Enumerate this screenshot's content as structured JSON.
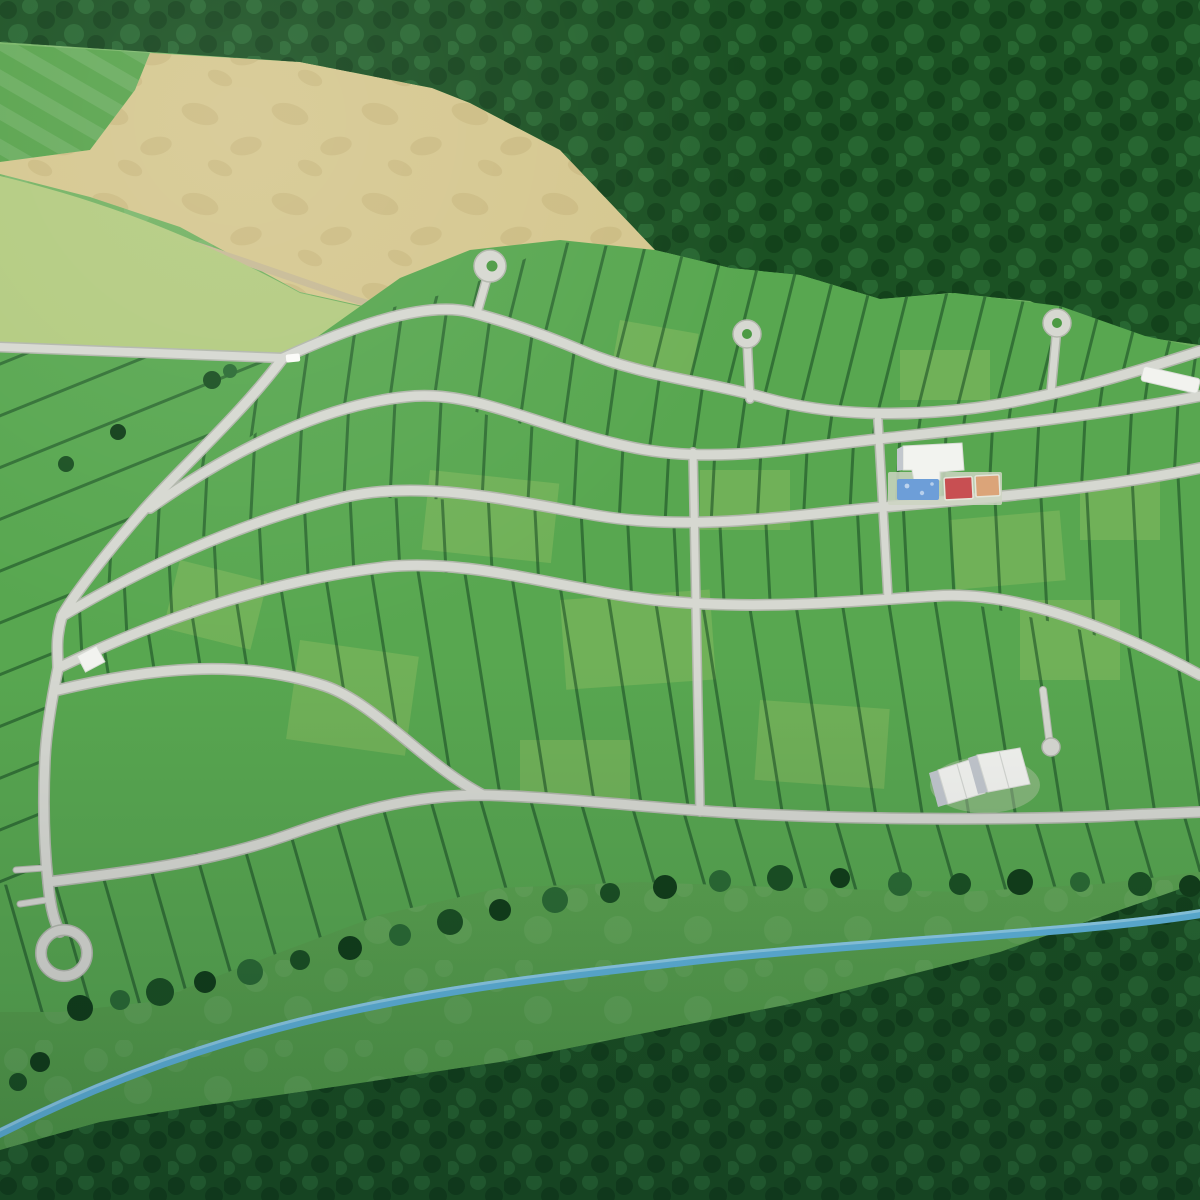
{
  "scene": {
    "title": "Aerial 3D render of a master-planned residential land development",
    "description": "Bird's-eye render of a subdivision of platted lots on curving streets with three cul-de-sacs, a loop lane, an amenity area with clubhouse, pool and sport courts, bordered by dense forest, farm fields and a blue creek",
    "labels": {
      "forest_top": "Forest canopy (north)",
      "forest_bottom": "Forest canopy (south)",
      "hedgerow": "Tree hedgerow along development edge",
      "harvested_field": "Harvested tan hay field",
      "mowed_field": "Mowed green field",
      "pale_field": "Fallow pale field",
      "meadow": "Open meadow",
      "creek": "Creek",
      "development": "Platted residential lots",
      "road_network": "Subdivision street network",
      "entrance_road": "Entrance road",
      "field_path": "Dirt field path",
      "cul_de_sac_west": "West cul-de-sac",
      "cul_de_sac_center": "Center cul-de-sac",
      "cul_de_sac_east": "East cul-de-sac",
      "loop_road": "Loop lane (southwest)",
      "hammerhead": "Hammerhead stub street",
      "clubhouse": "Clubhouse building",
      "pool": "Swimming pool",
      "court_red": "Red sport court",
      "court_clay": "Clay sport court",
      "maintenance_buildings": "White maintenance buildings",
      "shed": "Utility shed",
      "vehicle": "White vehicle on road",
      "trailer": "White trailer at east edge"
    },
    "counts": {
      "cul_de_sacs": 3,
      "street_arcs": 6,
      "amenity_courts": 2
    }
  },
  "colors": {
    "road": "#d6d8d1",
    "roadCasing": "#b2b7ac",
    "lotline": "#0e3d1c",
    "lotGreen": "#58a750",
    "lotPatch": "#b8cf6e",
    "forest": "#1b5123",
    "forestDark": "#123f1a",
    "forestLight": "#2b6b34",
    "fieldTan": "#d5c78f",
    "fieldTanDark": "#c2b074",
    "fieldPale": "#b3cb80",
    "fieldMow": "#58a34c",
    "meadowTop": "#7ab768",
    "meadowBottom": "#4f9a46",
    "stream": "#5fb4da",
    "streamHl": "#a8dcf0",
    "pathDirt": "#c7ba95",
    "building": "#f2f3ef",
    "buildingShadow": "#c2c7cd",
    "poolWater": "#6d9ed8",
    "courtRed": "#c84f52",
    "courtClay": "#dba479",
    "island": "#4c9a44"
  }
}
